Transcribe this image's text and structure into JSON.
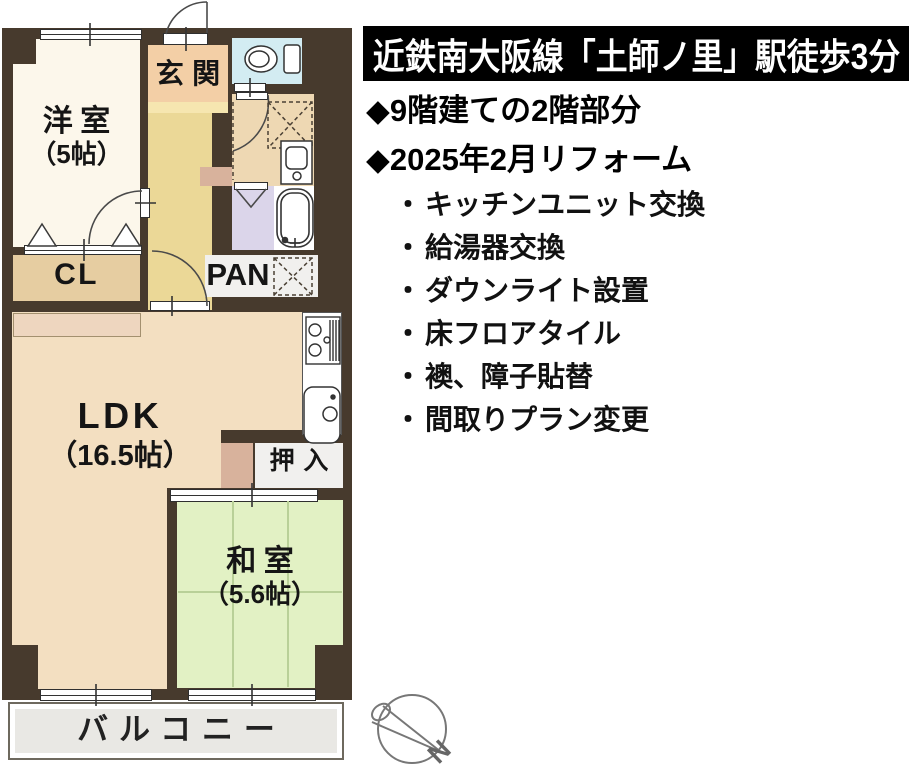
{
  "info": {
    "banner": "近鉄南大阪線「土師ノ里」駅徒歩3分",
    "marker": "◆",
    "bullet": "・",
    "highlights": [
      "9階建ての2階部分",
      "2025年2月リフォーム"
    ],
    "renovations": [
      "キッチンユニット交換",
      "給湯器交換",
      "ダウンライト設置",
      "床フロアタイル",
      "襖、障子貼替",
      "間取りプラン変更"
    ]
  },
  "floorplan": {
    "rooms": {
      "western_room": {
        "name": "洋室",
        "size": "（5帖）"
      },
      "entrance": {
        "name": "玄関"
      },
      "closet": {
        "name": "CL"
      },
      "pantry": {
        "name": "PAN"
      },
      "ldk": {
        "name": "LDK",
        "size": "（16.5帖）"
      },
      "oshiire": {
        "name": "押入"
      },
      "japanese_room": {
        "name": "和室",
        "size": "（5.6帖）"
      },
      "balcony": {
        "name": "バルコニー"
      }
    },
    "compass_label": "N",
    "colors": {
      "wall": "#473a2d",
      "western_room": "#fcf7eb",
      "entrance": "#f3cfa6",
      "hall": "#ebd897",
      "toilet": "#d3ecf2",
      "washroom": "#eed8b3",
      "bath": "#dbd5ea",
      "closet": "#e6cda1",
      "ldk": "#f3dfc1",
      "japanese_room": "#e2f1c4",
      "balcony": "#e9e8e4",
      "banner_bg": "#000000",
      "banner_text": "#ffffff"
    }
  }
}
